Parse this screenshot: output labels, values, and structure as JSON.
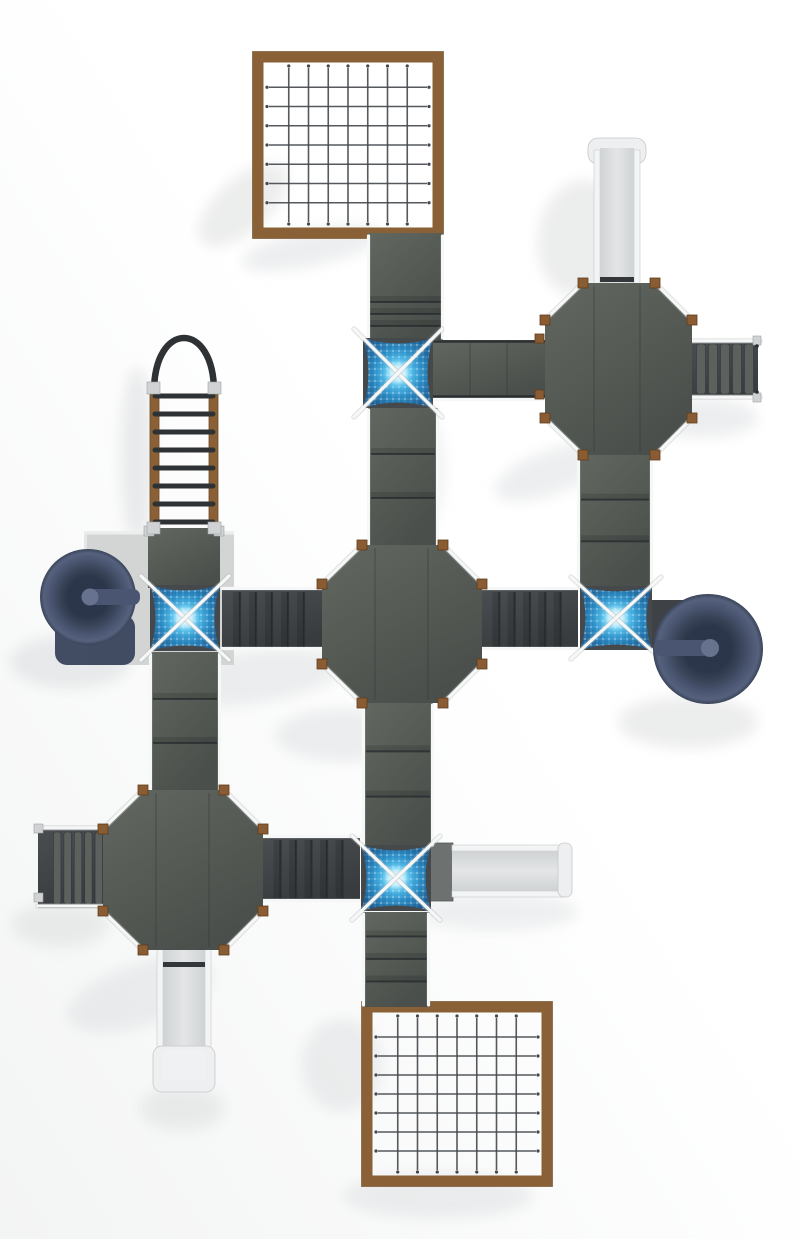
{
  "meta": {
    "description": "Top-down 3D render of a modular playground play structure",
    "view": "plan / top view",
    "canvas_width": 800,
    "canvas_height": 1239
  },
  "palette": {
    "bg": "#ffffff",
    "bg_wash": "#f3f4f4",
    "shadow": "#dcdedf",
    "deck": "#d3d5d4",
    "platform_a": "#626760",
    "platform_b": "#4a4f4b",
    "ramp_a": "#4a4e51",
    "ramp_b": "#383c3f",
    "tread": "#5c615d",
    "step_line": "#2b3033",
    "rope": "#43484c",
    "frame_brown": "#8a6136",
    "frame_brown_dark": "#6e4a24",
    "post_brown": "#8a5c33",
    "rail_white": "#f6f7f7",
    "rail_under": "#b8babc",
    "metal": "#d0d2d3",
    "slide_bed_a": "#e3e5e6",
    "slide_bed_b": "#d0d3d5",
    "slide_rail": "#f3f4f5",
    "slide_edge": "#c6c8ca",
    "slide_flare": "#edeff0",
    "entry_bar": "#33373a",
    "tube_deep": "#2c364b",
    "tube_mid": "#3a4459",
    "tube_outer": "#4a5571",
    "tube_rim": "#55617d",
    "tube_knob": "#67738e",
    "tube_foot": "#39435b",
    "xbase": "#45494c",
    "xnet_core": "#d6f6ff",
    "xnet_bright": "#56c4ef",
    "xnet_mid": "#2b8cc4",
    "xnet_edge": "#1d5f95",
    "arch": "#2e3235"
  },
  "nets": {
    "top": {
      "rows": 8,
      "cols": 8
    },
    "bottom": {
      "rows": 8,
      "cols": 8
    }
  },
  "ladder": {
    "rungs": 8
  },
  "stairs": {
    "right_treads": 5,
    "left_treads": 5
  },
  "ramps": {
    "net_to_top_x_panels": 3,
    "top_x_to_center_panels": 2,
    "tr_octagon_to_right_x_panels": 2,
    "center_to_bottom_x_panels": 2,
    "bottom_x_to_net_panels": 3,
    "left_x_to_bl_octagon_panels": 2,
    "left_x_to_center_steps": 5,
    "right_x_to_center_steps": 5,
    "bl_octagon_to_bottom_x_steps": 5
  },
  "components": [
    {
      "name": "cargo-net-top",
      "type": "rope climbing net, wood frame"
    },
    {
      "name": "cargo-net-bottom",
      "type": "rope climbing net, wood frame"
    },
    {
      "name": "octagon-tower-top-right",
      "type": "octagonal platform"
    },
    {
      "name": "octagon-tower-center",
      "type": "octagonal platform"
    },
    {
      "name": "octagon-tower-bottom-left",
      "type": "octagonal platform"
    },
    {
      "name": "x-net-junction-top",
      "type": "square rope-net junction"
    },
    {
      "name": "x-net-junction-left",
      "type": "square rope-net junction"
    },
    {
      "name": "x-net-junction-right",
      "type": "square rope-net junction"
    },
    {
      "name": "x-net-junction-bottom",
      "type": "square rope-net junction"
    },
    {
      "name": "tube-slide-left",
      "type": "spiral tube slide"
    },
    {
      "name": "tube-slide-right",
      "type": "spiral tube slide"
    },
    {
      "name": "straight-slide-top-right",
      "type": "open slide"
    },
    {
      "name": "straight-slide-bottom-left",
      "type": "open slide"
    },
    {
      "name": "straight-slide-right",
      "type": "open slide"
    },
    {
      "name": "arch-ladder-left",
      "type": "vertical rung ladder with arch handle"
    },
    {
      "name": "stairs-top-right",
      "type": "step run"
    },
    {
      "name": "stairs-bottom-left",
      "type": "step run"
    }
  ]
}
